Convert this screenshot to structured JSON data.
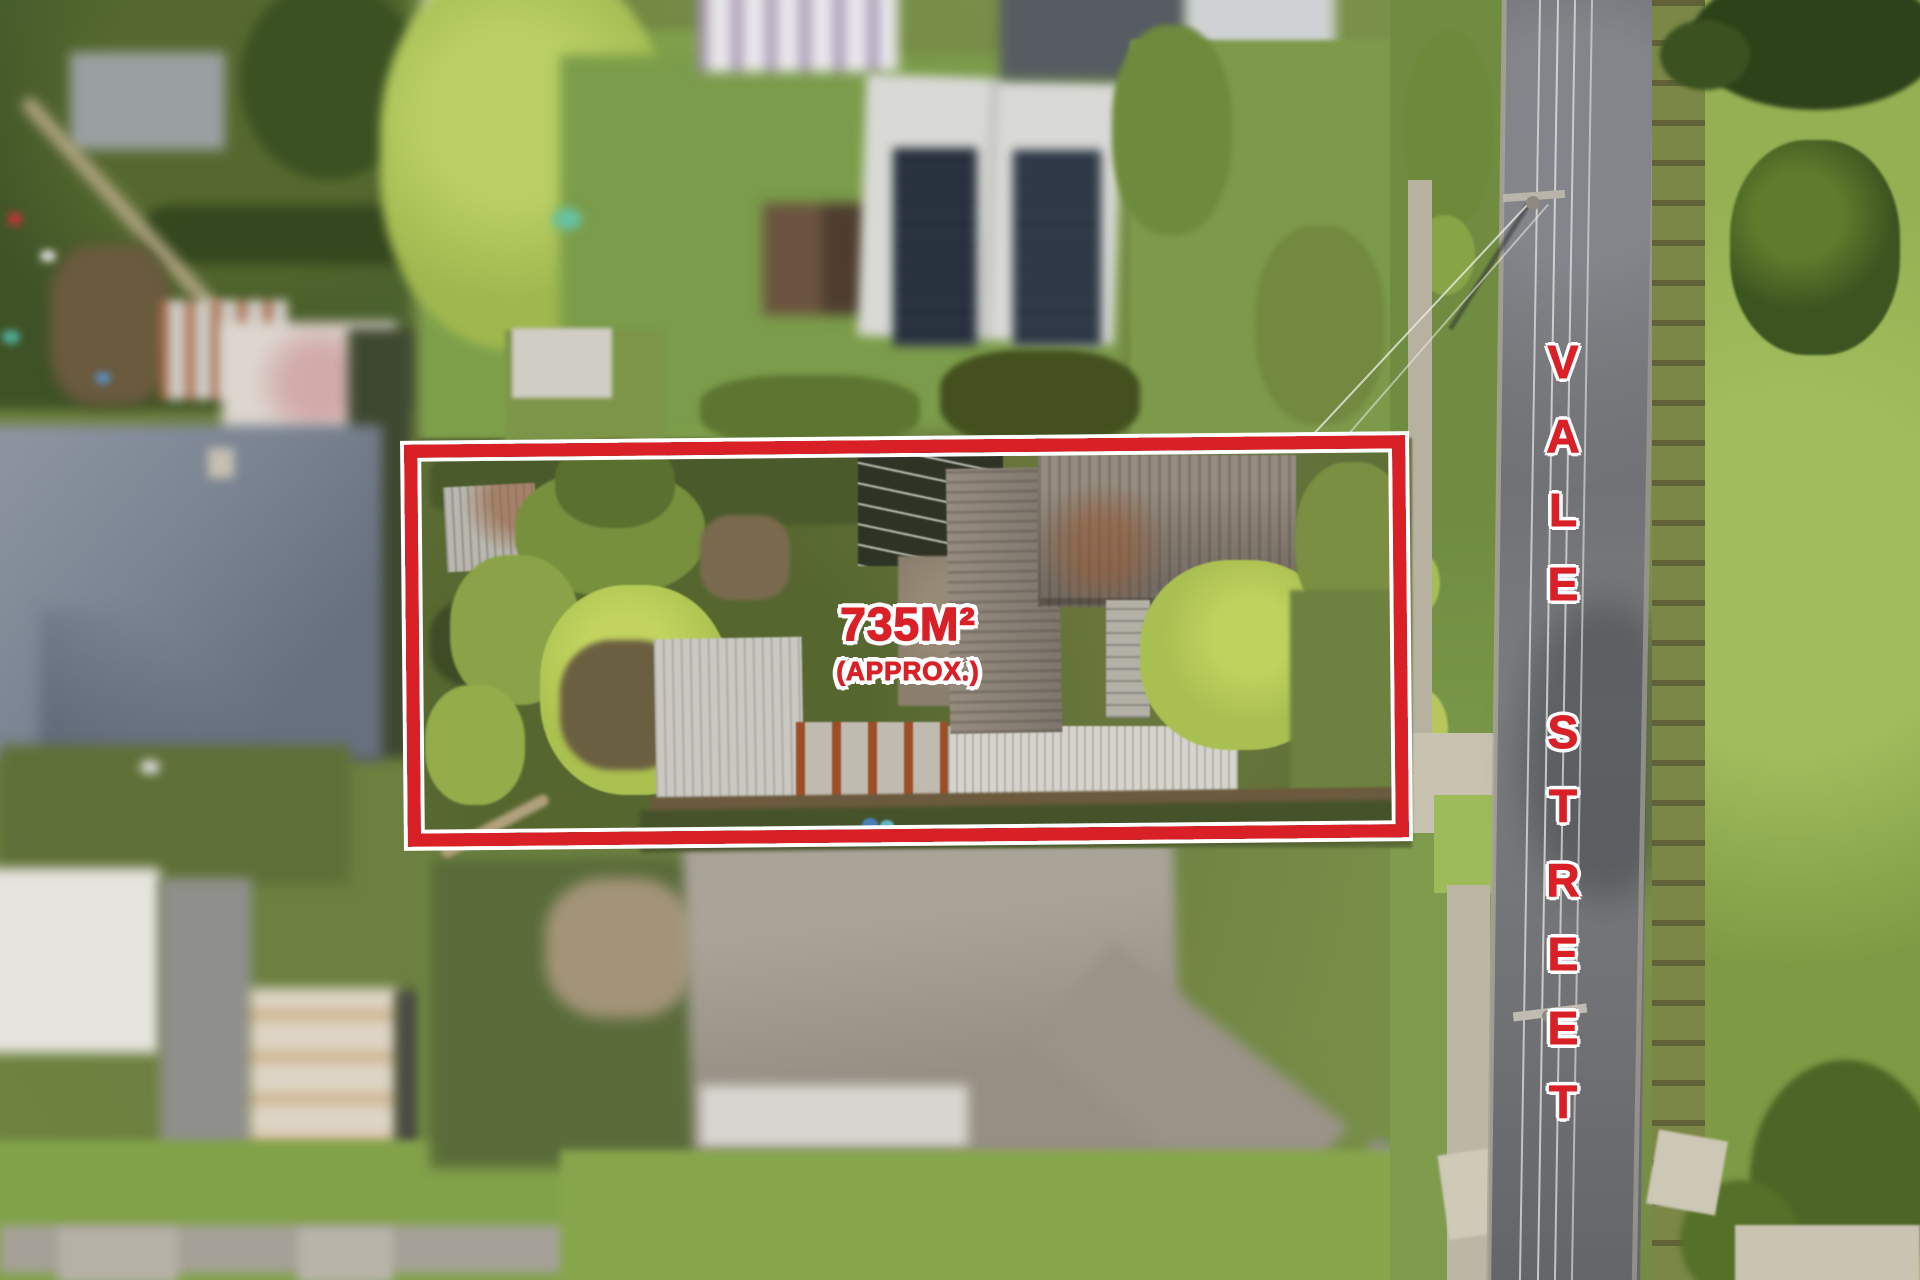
{
  "overlay": {
    "area_label": "735M²",
    "approx_label": "(APPROX.)",
    "street_label": "VALE STREET",
    "accent_color": "#d92027",
    "outline_color": "#ffffff"
  }
}
